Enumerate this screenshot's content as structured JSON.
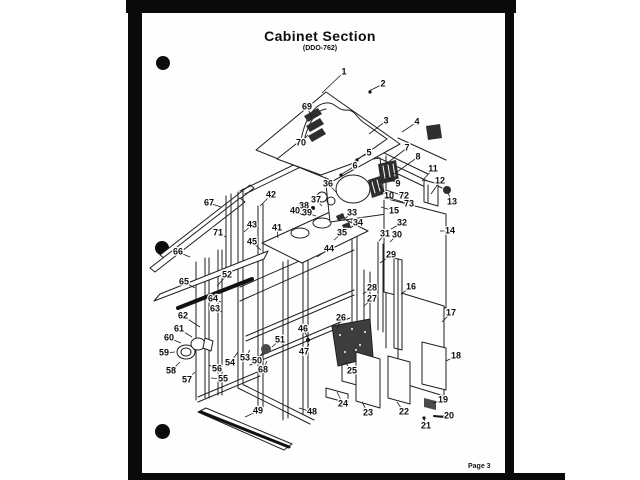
{
  "page": {
    "title": "Cabinet Section",
    "subtitle": "(DDO-762)",
    "page_number": "Page 3"
  },
  "colors": {
    "ink": "#1c1c1c",
    "paper": "#fefefe",
    "scan_edge": "#0a0a0a"
  },
  "diagram": {
    "description": "Exploded isometric parts view of appliance cabinet section with numbered callouts",
    "callouts": [
      {
        "n": "1",
        "x": 344,
        "y": 72,
        "tx": 322,
        "ty": 93
      },
      {
        "n": "2",
        "x": 383,
        "y": 84,
        "tx": 369,
        "ty": 91
      },
      {
        "n": "3",
        "x": 386,
        "y": 121,
        "tx": 369,
        "ty": 134
      },
      {
        "n": "4",
        "x": 417,
        "y": 122,
        "tx": 402,
        "ty": 132
      },
      {
        "n": "5",
        "x": 369,
        "y": 153,
        "tx": 357,
        "ty": 159
      },
      {
        "n": "6",
        "x": 355,
        "y": 166,
        "tx": 342,
        "ty": 174
      },
      {
        "n": "7",
        "x": 407,
        "y": 148,
        "tx": 386,
        "ty": 164
      },
      {
        "n": "8",
        "x": 418,
        "y": 157,
        "tx": 394,
        "ty": 174
      },
      {
        "n": "9",
        "x": 398,
        "y": 184,
        "tx": 385,
        "ty": 176
      },
      {
        "n": "10",
        "x": 389,
        "y": 196,
        "tx": 379,
        "ty": 186
      },
      {
        "n": "11",
        "x": 433,
        "y": 169,
        "tx": 422,
        "ty": 181
      },
      {
        "n": "12",
        "x": 440,
        "y": 181,
        "tx": 431,
        "ty": 194
      },
      {
        "n": "13",
        "x": 452,
        "y": 202,
        "tx": 448,
        "ty": 193
      },
      {
        "n": "14",
        "x": 450,
        "y": 231,
        "tx": 440,
        "ty": 231
      },
      {
        "n": "15",
        "x": 394,
        "y": 211,
        "tx": 381,
        "ty": 207
      },
      {
        "n": "16",
        "x": 411,
        "y": 287,
        "tx": 401,
        "ty": 294
      },
      {
        "n": "17",
        "x": 451,
        "y": 313,
        "tx": 442,
        "ty": 322
      },
      {
        "n": "18",
        "x": 456,
        "y": 356,
        "tx": 446,
        "ty": 361
      },
      {
        "n": "19",
        "x": 443,
        "y": 400,
        "tx": 433,
        "ty": 403
      },
      {
        "n": "20",
        "x": 449,
        "y": 416,
        "tx": 440,
        "ty": 416
      },
      {
        "n": "21",
        "x": 426,
        "y": 426,
        "tx": 424,
        "ty": 419
      },
      {
        "n": "22",
        "x": 404,
        "y": 412,
        "tx": 397,
        "ty": 402
      },
      {
        "n": "23",
        "x": 368,
        "y": 413,
        "tx": 362,
        "ty": 402
      },
      {
        "n": "24",
        "x": 343,
        "y": 404,
        "tx": 337,
        "ty": 392
      },
      {
        "n": "25",
        "x": 352,
        "y": 371,
        "tx": 345,
        "ty": 362
      },
      {
        "n": "26",
        "x": 341,
        "y": 318,
        "tx": 337,
        "ty": 329
      },
      {
        "n": "27",
        "x": 372,
        "y": 299,
        "tx": 364,
        "ty": 306
      },
      {
        "n": "28",
        "x": 372,
        "y": 288,
        "tx": 363,
        "ty": 294
      },
      {
        "n": "29",
        "x": 391,
        "y": 255,
        "tx": 380,
        "ty": 263
      },
      {
        "n": "30",
        "x": 397,
        "y": 235,
        "tx": 390,
        "ty": 242
      },
      {
        "n": "31",
        "x": 385,
        "y": 234,
        "tx": 379,
        "ty": 241
      },
      {
        "n": "32",
        "x": 402,
        "y": 223,
        "tx": 391,
        "ty": 229
      },
      {
        "n": "33",
        "x": 352,
        "y": 213,
        "tx": 343,
        "ty": 220
      },
      {
        "n": "34",
        "x": 358,
        "y": 223,
        "tx": 350,
        "ty": 228
      },
      {
        "n": "35",
        "x": 342,
        "y": 233,
        "tx": 334,
        "ty": 240
      },
      {
        "n": "36",
        "x": 328,
        "y": 184,
        "tx": 336,
        "ty": 192
      },
      {
        "n": "37",
        "x": 316,
        "y": 200,
        "tx": 322,
        "ty": 206
      },
      {
        "n": "38",
        "x": 304,
        "y": 206,
        "tx": 311,
        "ty": 211
      },
      {
        "n": "39",
        "x": 307,
        "y": 213,
        "tx": 316,
        "ty": 216
      },
      {
        "n": "40",
        "x": 295,
        "y": 211,
        "tx": 303,
        "ty": 215
      },
      {
        "n": "41",
        "x": 277,
        "y": 228,
        "tx": 278,
        "ty": 238
      },
      {
        "n": "42",
        "x": 271,
        "y": 195,
        "tx": 260,
        "ty": 206
      },
      {
        "n": "43",
        "x": 252,
        "y": 225,
        "tx": 244,
        "ty": 232
      },
      {
        "n": "44",
        "x": 329,
        "y": 249,
        "tx": 317,
        "ty": 257
      },
      {
        "n": "45",
        "x": 252,
        "y": 242,
        "tx": 261,
        "ty": 250
      },
      {
        "n": "46",
        "x": 303,
        "y": 329,
        "tx": 308,
        "ty": 338
      },
      {
        "n": "47",
        "x": 304,
        "y": 352,
        "tx": 309,
        "ty": 344
      },
      {
        "n": "48",
        "x": 312,
        "y": 412,
        "tx": 299,
        "ty": 408
      },
      {
        "n": "49",
        "x": 258,
        "y": 411,
        "tx": 245,
        "ty": 417
      },
      {
        "n": "50",
        "x": 257,
        "y": 361,
        "tx": 263,
        "ty": 352
      },
      {
        "n": "51",
        "x": 280,
        "y": 340,
        "tx": 272,
        "ty": 347
      },
      {
        "n": "52",
        "x": 227,
        "y": 275,
        "tx": 217,
        "ty": 286
      },
      {
        "n": "53",
        "x": 245,
        "y": 358,
        "tx": 250,
        "ty": 350
      },
      {
        "n": "54",
        "x": 230,
        "y": 363,
        "tx": 238,
        "ty": 352
      },
      {
        "n": "55",
        "x": 223,
        "y": 379,
        "tx": 211,
        "ty": 378
      },
      {
        "n": "56",
        "x": 217,
        "y": 369,
        "tx": 209,
        "ty": 365
      },
      {
        "n": "57",
        "x": 187,
        "y": 380,
        "tx": 195,
        "ty": 372
      },
      {
        "n": "58",
        "x": 171,
        "y": 371,
        "tx": 180,
        "ty": 362
      },
      {
        "n": "59",
        "x": 164,
        "y": 353,
        "tx": 175,
        "ty": 352
      },
      {
        "n": "60",
        "x": 169,
        "y": 338,
        "tx": 181,
        "ty": 343
      },
      {
        "n": "61",
        "x": 179,
        "y": 329,
        "tx": 192,
        "ty": 337
      },
      {
        "n": "62",
        "x": 183,
        "y": 316,
        "tx": 200,
        "ty": 327
      },
      {
        "n": "63",
        "x": 215,
        "y": 309,
        "tx": 222,
        "ty": 312
      },
      {
        "n": "64",
        "x": 213,
        "y": 299,
        "tx": 221,
        "ty": 302
      },
      {
        "n": "65",
        "x": 184,
        "y": 282,
        "tx": 195,
        "ty": 288
      },
      {
        "n": "66",
        "x": 178,
        "y": 252,
        "tx": 190,
        "ty": 257
      },
      {
        "n": "67",
        "x": 209,
        "y": 203,
        "tx": 221,
        "ty": 207
      },
      {
        "n": "68",
        "x": 263,
        "y": 370,
        "tx": 267,
        "ty": 361
      },
      {
        "n": "69",
        "x": 307,
        "y": 107,
        "tx": 312,
        "ty": 118
      },
      {
        "n": "70",
        "x": 301,
        "y": 143,
        "tx": 308,
        "ty": 135
      },
      {
        "n": "71",
        "x": 218,
        "y": 233,
        "tx": 226,
        "ty": 237
      },
      {
        "n": "72",
        "x": 404,
        "y": 196,
        "tx": 386,
        "ty": 190
      },
      {
        "n": "73",
        "x": 409,
        "y": 204,
        "tx": 387,
        "ty": 197
      }
    ]
  }
}
